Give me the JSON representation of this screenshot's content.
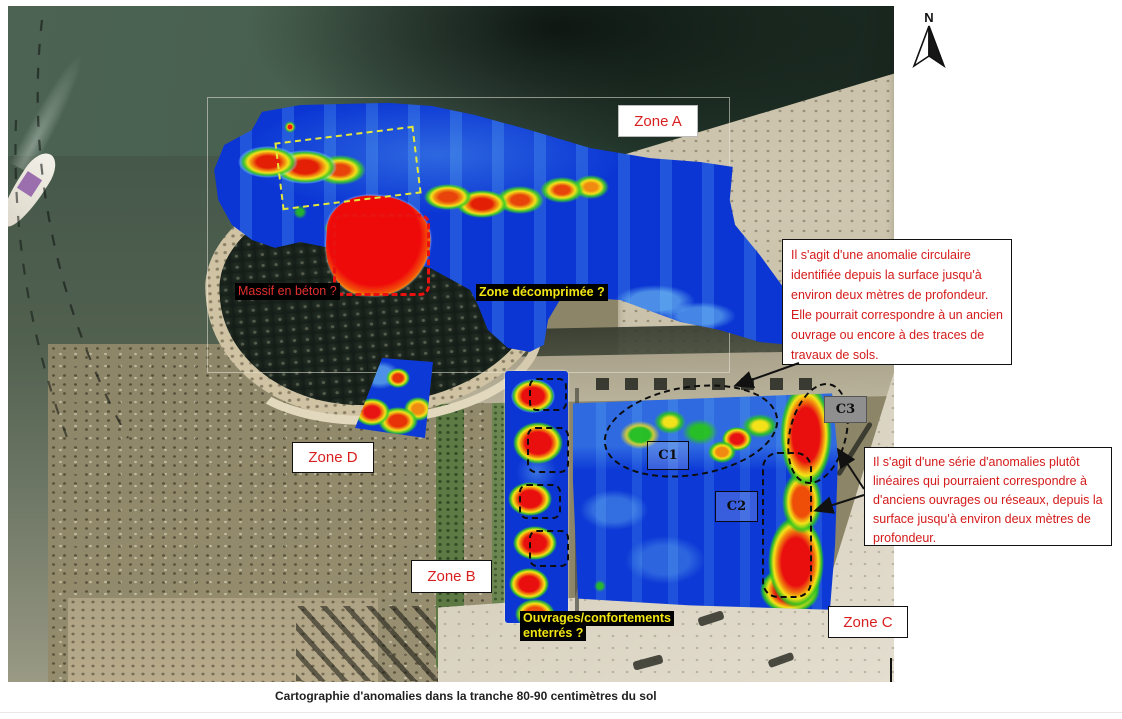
{
  "figure": {
    "caption": "Cartographie d'anomalies dans la tranche 80-90 centimètres du sol"
  },
  "compass": {
    "label": "N"
  },
  "zones": {
    "a": {
      "label": "Zone A"
    },
    "b": {
      "label": "Zone B"
    },
    "c": {
      "label": "Zone C"
    },
    "d": {
      "label": "Zone D"
    }
  },
  "markers": {
    "c1": {
      "label": "C1"
    },
    "c2": {
      "label": "C2"
    },
    "c3": {
      "label": "C3"
    }
  },
  "annotations": {
    "massif": {
      "label": "Massif en béton ?"
    },
    "decompressed": {
      "label": "Zone décomprimée ?"
    },
    "buried_line1": "Ouvrages/confortements",
    "buried_line2": "enterrés ?"
  },
  "callouts": {
    "circular_anomaly": {
      "text": "Il s'agit d'une anomalie circulaire identifiée depuis la surface jusqu'à environ deux mètres de profondeur. Elle pourrait correspondre à un ancien ouvrage ou encore à des traces de travaux de sols."
    },
    "linear_anomalies": {
      "text": "Il s'agit d'une série d'anomalies plutôt linéaires qui pourraient correspondre à d'anciens ouvrages ou réseaux, depuis la surface jusqu'à environ deux mètres de profondeur."
    }
  },
  "colors": {
    "annotation_red": "#d41a1a",
    "annotation_yellow": "#f2e613",
    "zone_label_red": "#d92020",
    "heat_low_blue": "#0b36d4",
    "heat_high_red": "#e81010",
    "marker_c3_bg": "#8f8f8f"
  }
}
